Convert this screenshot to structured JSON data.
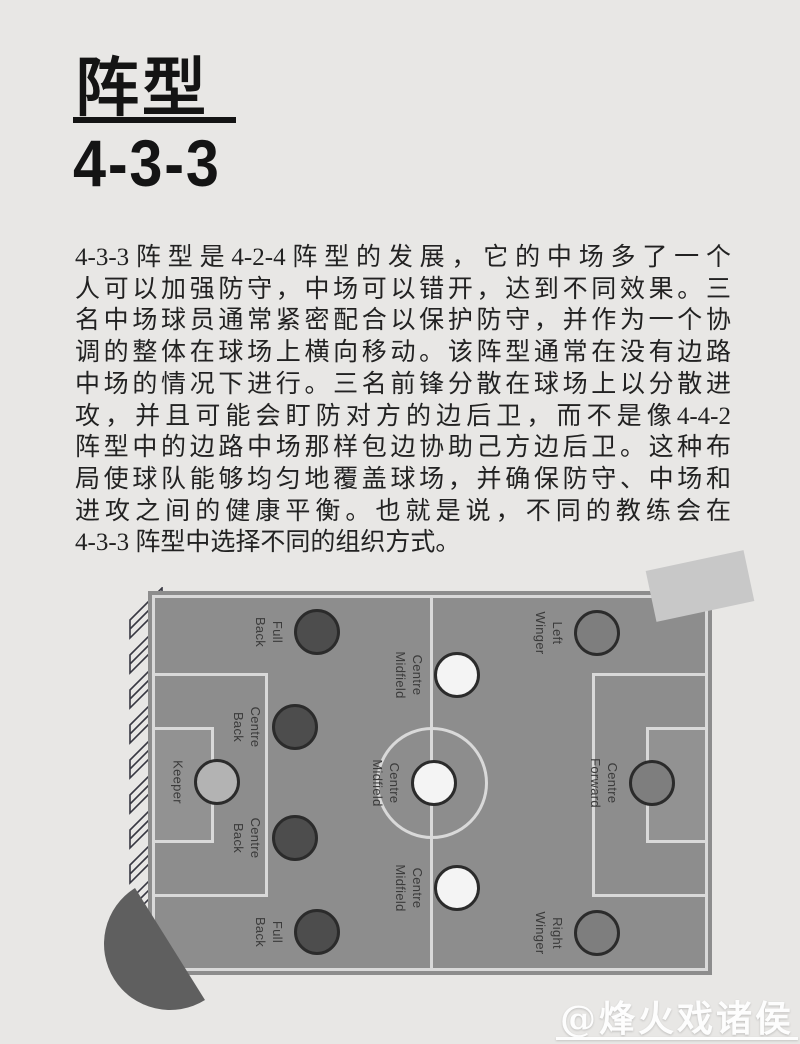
{
  "header": {
    "title": "阵型",
    "subtitle": "4-3-3"
  },
  "article": {
    "lines": [
      "4-3-3阵型是4-2-4阵型的发展，它的中场多了一个",
      "人可以加强防守，中场可以错开，达到不同效果。三",
      "名中场球员通常紧密配合以保护防守，并作为一个协",
      "调的整体在球场上横向移动。该阵型通常在没有边路",
      "中场的情况下进行。三名前锋分散在球场上以分散进",
      "攻，并且可能会盯防对方的边后卫，而不是像4-4-2",
      "阵型中的边路中场那样包边协助己方边后卫。这种布",
      "局使球队能够均匀地覆盖球场，并确保防守、中场和",
      "进攻之间的健康平衡。也就是说，不同的教练会在",
      "4-3-3 阵型中选择不同的组织方式。"
    ]
  },
  "diagram": {
    "formation": "4-3-3",
    "colors": {
      "pitch_fill": "#8d8d8d",
      "pitch_line": "#d9d9d9",
      "keeper_fill": "#b3b3b3",
      "defender_fill": "#4d4d4d",
      "midfielder_fill": "#f4f4f4",
      "forward_fill": "#7e7e7e",
      "circle_stroke": "#2b2b2b"
    },
    "players": [
      {
        "id": "keeper",
        "label": "Keeper",
        "role": "gk",
        "x": 217,
        "y": 222
      },
      {
        "id": "full-back-top",
        "label": "Full\nBack",
        "role": "def",
        "x": 317,
        "y": 72
      },
      {
        "id": "centre-back-top",
        "label": "Centre\nBack",
        "role": "def",
        "x": 295,
        "y": 167
      },
      {
        "id": "centre-back-bottom",
        "label": "Centre\nBack",
        "role": "def",
        "x": 295,
        "y": 278
      },
      {
        "id": "full-back-bottom",
        "label": "Full\nBack",
        "role": "def",
        "x": 317,
        "y": 372
      },
      {
        "id": "centre-midfield-top",
        "label": "Centre\nMidfield",
        "role": "mid",
        "x": 457,
        "y": 115
      },
      {
        "id": "centre-midfield-centre",
        "label": "Centre\nMidfield",
        "role": "mid",
        "x": 434,
        "y": 223
      },
      {
        "id": "centre-midfield-bottom",
        "label": "Centre\nMidfield",
        "role": "mid",
        "x": 457,
        "y": 328
      },
      {
        "id": "left-winger",
        "label": "Left\nWinger",
        "role": "fwd",
        "x": 597,
        "y": 73
      },
      {
        "id": "centre-forward",
        "label": "Centre\nForward",
        "role": "fwd",
        "x": 652,
        "y": 223
      },
      {
        "id": "right-winger",
        "label": "Right\nWinger",
        "role": "fwd",
        "x": 597,
        "y": 373
      }
    ]
  },
  "watermark": {
    "text": "@烽火戏诸侯"
  },
  "page": {
    "background": "#e8e7e5"
  }
}
